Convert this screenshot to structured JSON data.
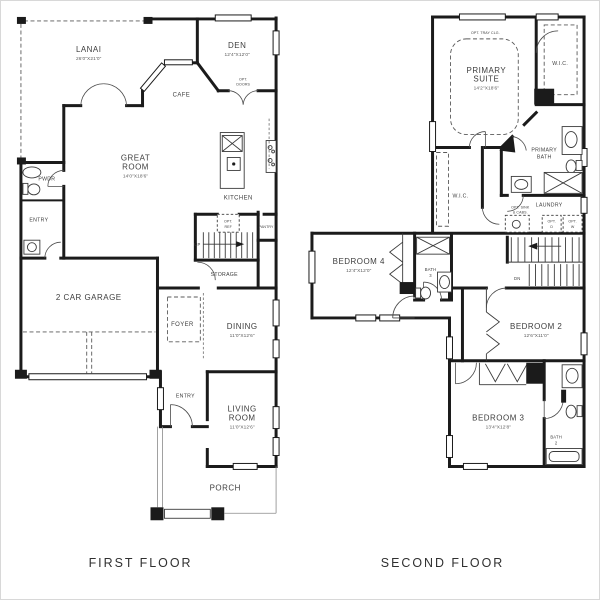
{
  "floors": {
    "first": {
      "title": "FIRST FLOOR",
      "lanai": "LANAI",
      "lanai_dims": "26'0\"X21'0\"",
      "den": "DEN",
      "den_dims": "12'4\"X12'0\"",
      "opt_doors_l1": "OPT.",
      "opt_doors_l2": "DOORS",
      "cafe": "CAFE",
      "great_l1": "GREAT",
      "great_l2": "ROOM",
      "great_dims": "14'0\"X18'6\"",
      "kitchen": "KITCHEN",
      "pantry": "PANTRY",
      "opt_ref_l1": "OPT.",
      "opt_ref_l2": "REF",
      "up": "UP",
      "storage": "STORAGE",
      "pwdr": "PWDR",
      "entry_side": "ENTRY",
      "garage": "2 CAR GARAGE",
      "foyer": "FOYER",
      "dining": "DINING",
      "dining_dims": "11'0\"X12'6\"",
      "entry_front": "ENTRY",
      "living_l1": "LIVING",
      "living_l2": "ROOM",
      "living_dims": "11'0\"X12'6\"",
      "porch": "PORCH"
    },
    "second": {
      "title": "SECOND FLOOR",
      "opt_tray": "OPT. TRAY CLG.",
      "primary_l1": "PRIMARY",
      "primary_l2": "SUITE",
      "primary_dims": "14'2\"X18'6\"",
      "wic_a": "W.I.C.",
      "wic_b": "W.I.C.",
      "pbath_l1": "PRIMARY",
      "pbath_l2": "BATH",
      "laundry": "LAUNDRY",
      "opt_sink_l1": "OPT. SINK",
      "opt_sink_l2": "& CABS.",
      "opt_d_l1": "OPT.",
      "opt_d_l2": "D",
      "opt_w_l1": "OPT.",
      "opt_w_l2": "W",
      "dn": "DN",
      "bed4": "BEDROOM 4",
      "bed4_dims": "12'4\"X12'0\"",
      "bath3_l1": "BATH",
      "bath3_l2": "3",
      "bed2": "BEDROOM 2",
      "bed2_dims": "12'6\"X11'0\"",
      "bed3": "BEDROOM 3",
      "bed3_dims": "13'4\"X12'8\"",
      "bath2_l1": "BATH",
      "bath2_l2": "2"
    }
  },
  "colors": {
    "wall": "#1b1b1b",
    "text": "#3d3d3d",
    "background": "#ffffff"
  }
}
